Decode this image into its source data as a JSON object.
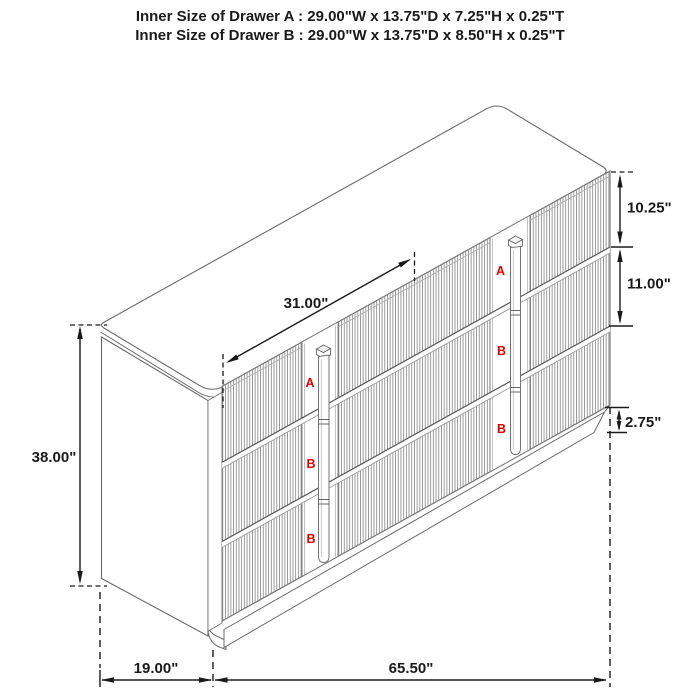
{
  "title": {
    "line1": "Inner Size of Drawer A : 29.00\"W x 13.75\"D x 7.25\"H x 0.25\"T",
    "line2": "Inner Size of Drawer B : 29.00\"W x 13.75\"D x 8.50\"H x 0.25\"T"
  },
  "drawer_labels": {
    "a": "A",
    "b": "B"
  },
  "dims": {
    "top_span": "31.00\"",
    "height": "38.00\"",
    "top_drawer_height": "10.25\"",
    "middle_drawer_height": "11.00\"",
    "base_height": "2.75\"",
    "depth": "19.00\"",
    "width": "65.50\""
  },
  "colors": {
    "dimension_line": "#1a1a1a",
    "drawing_line": "#6a6a6a",
    "flute_line": "#8a8a8a",
    "label_red": "#e60000",
    "background": "#ffffff"
  }
}
